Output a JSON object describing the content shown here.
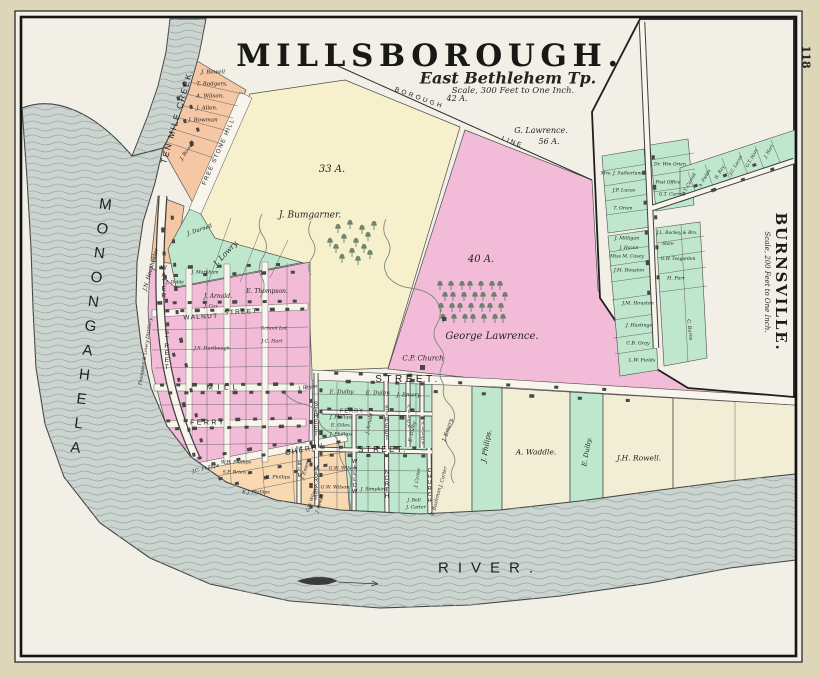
{
  "page": {
    "number": "118"
  },
  "map": {
    "title": "MILLSBOROUGH.",
    "township": "East Bethlehem Tp.",
    "scale_note": "Scale, 300 Feet to One Inch."
  },
  "inset": {
    "title": "BURNSVILLE.",
    "scale_note": "Scale, 200 Feet to One Inch."
  },
  "colors": {
    "mat": "#ddd6b8",
    "paper": "#f1efe6",
    "road": "#f7f5ec",
    "river": "#ccd4d0",
    "wave": "#9aaba6",
    "yellow": "#f6f0cc",
    "pink": "#f2bcd9",
    "green": "#bfe7cd",
    "salmon": "#f5c7a4",
    "orange": "#f8d9b2",
    "palestrip": "#f2eed6",
    "ink": "#1c1c1c",
    "bld": "#474747",
    "stream": "#7c8c80",
    "tree": "#5c7560",
    "line": "#4d4d4d"
  },
  "labels": [
    {
      "t": "33 A.",
      "x": 332,
      "y": 170,
      "fs": 10
    },
    {
      "t": "J. Bumgarner.",
      "x": 310,
      "y": 216,
      "fs": 9
    },
    {
      "t": "42 A.",
      "x": 457,
      "y": 99,
      "fs": 8
    },
    {
      "t": "G. Lawrence.",
      "x": 541,
      "y": 131,
      "fs": 8
    },
    {
      "t": "56 A.",
      "x": 549,
      "y": 142,
      "fs": 8
    },
    {
      "t": "40 A.",
      "x": 481,
      "y": 260,
      "fs": 10
    },
    {
      "t": "George Lawrence.",
      "x": 492,
      "y": 337,
      "fs": 10
    },
    {
      "t": "C.P. Church",
      "x": 423,
      "y": 359,
      "fs": 7
    },
    {
      "t": "BOROUGH",
      "x": 419,
      "y": 99,
      "fs": 6.5,
      "r": 20,
      "ls": 0.4,
      "c": "s"
    },
    {
      "t": "LINE",
      "x": 512,
      "y": 143,
      "fs": 6.5,
      "r": 21,
      "ls": 0.3,
      "c": "s"
    },
    {
      "t": "FREE STONE HILL",
      "x": 219,
      "y": 152,
      "fs": 6,
      "r": -66,
      "ls": 0.22,
      "c": "s"
    },
    {
      "t": "TEN MILE CREEK.",
      "x": 177,
      "y": 116,
      "fs": 8.5,
      "r": -74,
      "ls": 0.2,
      "c": "s"
    },
    {
      "t": "MONONGAHELA",
      "x": 90,
      "y": 330,
      "fs": 15,
      "ls": 0.5,
      "r": 7,
      "c": "v"
    },
    {
      "t": "RIVER.",
      "x": 490,
      "y": 568,
      "fs": 15,
      "ls": 0.6,
      "c": "s"
    },
    {
      "t": "STREET.",
      "x": 408,
      "y": 380,
      "fs": 10,
      "ls": 0.35,
      "c": "s"
    },
    {
      "t": "STREET.",
      "x": 383,
      "y": 450,
      "fs": 8,
      "ls": 0.3,
      "c": "s"
    },
    {
      "t": "MILL",
      "x": 224,
      "y": 387,
      "fs": 7.5,
      "ls": 0.6,
      "c": "s"
    },
    {
      "t": "FERRY",
      "x": 208,
      "y": 423,
      "fs": 7,
      "ls": 0.35,
      "c": "s"
    },
    {
      "t": "WALNUT",
      "x": 201,
      "y": 318,
      "fs": 6.5,
      "r": -3,
      "ls": 0.2,
      "c": "s"
    },
    {
      "t": "STREET",
      "x": 241,
      "y": 313,
      "fs": 6.5,
      "r": -3,
      "ls": 0.2,
      "c": "s"
    },
    {
      "t": "CHERRY",
      "x": 305,
      "y": 450,
      "fs": 7,
      "r": -11,
      "ls": 0.25,
      "c": "s"
    },
    {
      "t": "FERRY",
      "x": 352,
      "y": 412,
      "fs": 5.5,
      "ls": 0.2,
      "c": "s"
    },
    {
      "t": "WATER",
      "x": 163,
      "y": 282,
      "fs": 6.5,
      "c": "v"
    },
    {
      "t": "STREET",
      "x": 166,
      "y": 350,
      "fs": 6.5,
      "c": "v"
    },
    {
      "t": "MARKET",
      "x": 316,
      "y": 484,
      "fs": 6,
      "c": "v"
    },
    {
      "t": "STREET",
      "x": 316,
      "y": 420,
      "fs": 6,
      "c": "v"
    },
    {
      "t": "WILLOW",
      "x": 354,
      "y": 477,
      "fs": 5.5,
      "c": "v"
    },
    {
      "t": "NORTH",
      "x": 387,
      "y": 485,
      "fs": 6,
      "c": "v"
    },
    {
      "t": "STREET",
      "x": 387,
      "y": 424,
      "fs": 6,
      "c": "v"
    },
    {
      "t": "ALLEY",
      "x": 408,
      "y": 417,
      "fs": 4.8,
      "c": "v"
    },
    {
      "t": "ALLEY",
      "x": 422,
      "y": 434,
      "fs": 4.8,
      "c": "v"
    },
    {
      "t": "CHURCH",
      "x": 429,
      "y": 486,
      "fs": 5.2,
      "c": "v"
    },
    {
      "t": "ELM",
      "x": 299,
      "y": 470,
      "fs": 5.5,
      "c": "v"
    },
    {
      "t": "J. Bowell",
      "x": 213,
      "y": 73,
      "fs": 5.5
    },
    {
      "t": "T. Rodgers.",
      "x": 212,
      "y": 85,
      "fs": 5.5
    },
    {
      "t": "A. Wilson.",
      "x": 210,
      "y": 97,
      "fs": 5.5
    },
    {
      "t": "J. Allen.",
      "x": 207,
      "y": 109,
      "fs": 5.5
    },
    {
      "t": "J. Bowman",
      "x": 203,
      "y": 121,
      "fs": 5.5
    },
    {
      "t": "J. Bowell",
      "x": 188,
      "y": 151,
      "fs": 5,
      "r": -55
    },
    {
      "t": "J.N. Housholder",
      "x": 152,
      "y": 270,
      "fs": 5.5,
      "r": -74
    },
    {
      "t": "Thompson & Lowry Distillery",
      "x": 147,
      "y": 352,
      "fs": 4.6,
      "r": -81
    },
    {
      "t": "J. Darnell",
      "x": 200,
      "y": 231,
      "fs": 5.5,
      "r": -18
    },
    {
      "t": "J. Lowry.",
      "x": 226,
      "y": 253,
      "fs": 7.5,
      "r": -47
    },
    {
      "t": "J. Markham",
      "x": 205,
      "y": 274,
      "fs": 4.6
    },
    {
      "t": "J. Doble",
      "x": 175,
      "y": 284,
      "fs": 4.6
    },
    {
      "t": "E. Thompson.",
      "x": 267,
      "y": 292,
      "fs": 6
    },
    {
      "t": "J. Arnold.",
      "x": 218,
      "y": 297,
      "fs": 6
    },
    {
      "t": "J. Cox",
      "x": 211,
      "y": 308,
      "fs": 4.8
    },
    {
      "t": "School Lot",
      "x": 274,
      "y": 330,
      "fs": 4.8
    },
    {
      "t": "J.C. Hart",
      "x": 272,
      "y": 343,
      "fs": 4.8
    },
    {
      "t": "J.S. Hartbaugh",
      "x": 212,
      "y": 350,
      "fs": 4.8
    },
    {
      "t": "J. Bryan",
      "x": 308,
      "y": 389,
      "fs": 4.8,
      "r": -8
    },
    {
      "t": "E. Dulby.",
      "x": 342,
      "y": 393,
      "fs": 5.5
    },
    {
      "t": "E. Dulby.",
      "x": 378,
      "y": 394,
      "fs": 5.5
    },
    {
      "t": "J. Emery.",
      "x": 409,
      "y": 396,
      "fs": 5.5
    },
    {
      "t": "J. Phillips",
      "x": 341,
      "y": 419,
      "fs": 4.8
    },
    {
      "t": "E. Giles.",
      "x": 341,
      "y": 427,
      "fs": 4.8
    },
    {
      "t": "J. Phillips",
      "x": 341,
      "y": 436,
      "fs": 4.8
    },
    {
      "t": "J. Arnold",
      "x": 371,
      "y": 424,
      "fs": 4.8,
      "r": -78
    },
    {
      "t": "E. Dulby",
      "x": 414,
      "y": 432,
      "fs": 4.8,
      "r": -78
    },
    {
      "t": "G.W. Wilson",
      "x": 343,
      "y": 470,
      "fs": 4.8
    },
    {
      "t": "G.W. Wilson",
      "x": 335,
      "y": 489,
      "fs": 4.8
    },
    {
      "t": "J. Simpkins",
      "x": 374,
      "y": 491,
      "fs": 4.8
    },
    {
      "t": "J. Carter",
      "x": 419,
      "y": 478,
      "fs": 4.6,
      "r": -80
    },
    {
      "t": "J. Bell",
      "x": 414,
      "y": 502,
      "fs": 4.6
    },
    {
      "t": "J. Carter",
      "x": 416,
      "y": 509,
      "fs": 4.6
    },
    {
      "t": "J.C. Phillips",
      "x": 206,
      "y": 470,
      "fs": 4.8,
      "r": -13
    },
    {
      "t": "W.B. Phillips",
      "x": 236,
      "y": 464,
      "fs": 4.8
    },
    {
      "t": "S.P. Brien.",
      "x": 235,
      "y": 474,
      "fs": 4.8
    },
    {
      "t": "E. Phillips",
      "x": 278,
      "y": 479,
      "fs": 4.8
    },
    {
      "t": "E.J. Phillips",
      "x": 256,
      "y": 494,
      "fs": 4.8
    },
    {
      "t": "J. Emery",
      "x": 307,
      "y": 470,
      "fs": 4.8,
      "r": -72
    },
    {
      "t": "G.W. Wilson",
      "x": 313,
      "y": 500,
      "fs": 4.4,
      "r": -72
    },
    {
      "t": "J. Powell",
      "x": 321,
      "y": 504,
      "fs": 4.4,
      "r": -72
    },
    {
      "t": "J. Emery.",
      "x": 449,
      "y": 430,
      "fs": 5.5,
      "r": -72
    },
    {
      "t": "J. Carter",
      "x": 444,
      "y": 477,
      "fs": 5,
      "r": -76
    },
    {
      "t": "T. Bushman",
      "x": 437,
      "y": 502,
      "fs": 5,
      "r": -76
    },
    {
      "t": "J. Philips.",
      "x": 487,
      "y": 446,
      "fs": 7,
      "r": -80
    },
    {
      "t": "A. Waddle.",
      "x": 536,
      "y": 452,
      "fs": 7.5
    },
    {
      "t": "E. Dulby.",
      "x": 587,
      "y": 452,
      "fs": 6.5,
      "r": -80
    },
    {
      "t": "J.H. Rowell.",
      "x": 639,
      "y": 458,
      "fs": 7.5
    }
  ],
  "inset_labels": [
    {
      "t": "Mrs. J. Sutherland",
      "x": 622,
      "y": 175,
      "fs": 4.6
    },
    {
      "t": "J.P. Lucas",
      "x": 624,
      "y": 192,
      "fs": 4.8
    },
    {
      "t": "T. Orien",
      "x": 623,
      "y": 210,
      "fs": 4.8
    },
    {
      "t": "Dr. Wm Orien",
      "x": 670,
      "y": 166,
      "fs": 4.6
    },
    {
      "t": "Post Office",
      "x": 668,
      "y": 184,
      "fs": 4.6
    },
    {
      "t": "G.T. Carroll",
      "x": 672,
      "y": 196,
      "fs": 4.6
    },
    {
      "t": "G.T. Carroll",
      "x": 690,
      "y": 185,
      "fs": 4.4,
      "r": -60
    },
    {
      "t": "A. Fields",
      "x": 706,
      "y": 179,
      "fs": 4.4,
      "r": -60
    },
    {
      "t": "R. Ray",
      "x": 721,
      "y": 173,
      "fs": 4.4,
      "r": -60
    },
    {
      "t": "J.C. Lucas",
      "x": 737,
      "y": 166,
      "fs": 4.4,
      "r": -60
    },
    {
      "t": "G.T. Hart",
      "x": 753,
      "y": 159,
      "fs": 4.4,
      "r": -60
    },
    {
      "t": "J. Hart",
      "x": 770,
      "y": 152,
      "fs": 4.4,
      "r": -60
    },
    {
      "t": "J. Milligan",
      "x": 627,
      "y": 240,
      "fs": 4.8
    },
    {
      "t": "J. Hazen",
      "x": 629,
      "y": 249,
      "fs": 4.4
    },
    {
      "t": "Miss M. Casey",
      "x": 627,
      "y": 258,
      "fs": 4.6
    },
    {
      "t": "J.M. Houston",
      "x": 629,
      "y": 272,
      "fs": 4.6
    },
    {
      "t": "J.M. Houston",
      "x": 638,
      "y": 305,
      "fs": 4.8
    },
    {
      "t": "J. Hastings",
      "x": 639,
      "y": 327,
      "fs": 4.8
    },
    {
      "t": "C.B. Gray",
      "x": 638,
      "y": 345,
      "fs": 4.8
    },
    {
      "t": "L.W. Fields",
      "x": 642,
      "y": 362,
      "fs": 4.8
    },
    {
      "t": "J.L. Rackey & Bro.",
      "x": 677,
      "y": 234,
      "fs": 4.4
    },
    {
      "t": "Store",
      "x": 668,
      "y": 244,
      "fs": 4.2
    },
    {
      "t": "G.W. Teagarden",
      "x": 678,
      "y": 260,
      "fs": 4.4
    },
    {
      "t": "H. Parr",
      "x": 676,
      "y": 280,
      "fs": 4.8
    },
    {
      "t": "C. Burns",
      "x": 688,
      "y": 330,
      "fs": 4.8,
      "r": 83
    }
  ]
}
